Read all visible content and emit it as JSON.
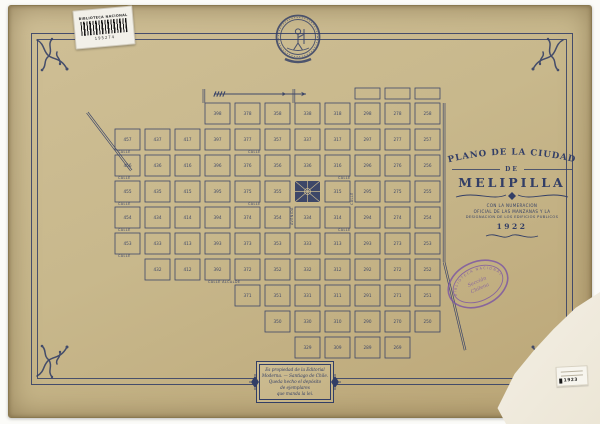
{
  "barcode": {
    "institution": "BIBLIOTECA NACIONAL",
    "number": "195274"
  },
  "cartouche": {
    "title": "PLANO DE LA CIUDAD",
    "de_label": "DE",
    "city": "MELIPILLA",
    "subtitle_lines": [
      "CON LA NUMERACION",
      "OFICIAL DE LAS MANZANAS Y LA",
      "DESIGNACION DE LOS EDIFICIOS PUBLICOS"
    ],
    "year": "1922"
  },
  "stamp": {
    "ring_text": "BIBLIOTECA NACIONAL",
    "center_line1": "Sección",
    "center_line2": "Chilena",
    "color": "#7a54a4"
  },
  "imprint": {
    "lines": [
      "Es propiedad de la Editorial",
      "Moderna. — Santiago de Chile.",
      "Queda hecho el depósito",
      "de ejemplares",
      "que manda la lei."
    ]
  },
  "sticker": {
    "number": "1923"
  },
  "colors": {
    "paper": "#c8b88c",
    "ink": "#323e66",
    "stamp_purple": "#7a54a4"
  },
  "map": {
    "ink": "#323e66",
    "paper": "#cbbb90",
    "grid": {
      "x0": 115,
      "y0": 103,
      "cell_w": 30,
      "cell_h": 26,
      "block_w": 25,
      "block_h": 21
    },
    "rows": [
      [
        null,
        null,
        null,
        "398",
        "378",
        "358",
        "338",
        "318",
        "298",
        "278",
        "258"
      ],
      [
        "457",
        "437",
        "417",
        "397",
        "377",
        "357",
        "337",
        "317",
        "297",
        "277",
        "257"
      ],
      [
        "456",
        "436",
        "416",
        "396",
        "376",
        "356",
        "336",
        "316",
        "296",
        "276",
        "256"
      ],
      [
        "455",
        "435",
        "415",
        "395",
        "375",
        "355",
        null,
        "315",
        "295",
        "275",
        "255"
      ],
      [
        "454",
        "434",
        "414",
        "394",
        "374",
        "354",
        "334",
        "314",
        "294",
        "274",
        "254"
      ],
      [
        "453",
        "433",
        "413",
        "393",
        "373",
        "353",
        "333",
        "313",
        "293",
        "273",
        "253"
      ],
      [
        null,
        "432",
        "412",
        "392",
        "372",
        "352",
        "332",
        "312",
        "292",
        "272",
        "252"
      ],
      [
        null,
        null,
        null,
        null,
        "371",
        "351",
        "331",
        "311",
        "291",
        "271",
        "251"
      ],
      [
        null,
        null,
        null,
        null,
        null,
        "350",
        "330",
        "310",
        "290",
        "270",
        "250"
      ],
      [
        null,
        null,
        null,
        null,
        null,
        null,
        "329",
        "309",
        "289",
        "269",
        null
      ]
    ],
    "plaza": {
      "row": 3,
      "col": 6
    },
    "extra_blocks": [
      {
        "x": 355,
        "y": 88,
        "w": 25,
        "h": 11
      },
      {
        "x": 385,
        "y": 88,
        "w": 25,
        "h": 11
      },
      {
        "x": 415,
        "y": 88,
        "w": 25,
        "h": 11
      }
    ],
    "roads": [
      {
        "x1": 88,
        "y1": 112,
        "x2": 132,
        "y2": 170
      },
      {
        "x1": 445,
        "y1": 103,
        "x2": 445,
        "y2": 262
      },
      {
        "x1": 445,
        "y1": 262,
        "x2": 466,
        "y2": 350
      },
      {
        "x1": 293,
        "y1": 103,
        "x2": 293,
        "y2": 89
      },
      {
        "x1": 203,
        "y1": 103,
        "x2": 203,
        "y2": 89
      }
    ],
    "street_labels": [
      {
        "x": 118,
        "y": 153,
        "t": "CALLE",
        "r": 0
      },
      {
        "x": 248,
        "y": 153,
        "t": "CALLE",
        "r": 0
      },
      {
        "x": 118,
        "y": 179,
        "t": "CALLE",
        "r": 0
      },
      {
        "x": 338,
        "y": 179,
        "t": "CALLE",
        "r": 0
      },
      {
        "x": 118,
        "y": 205,
        "t": "CALLE",
        "r": 0
      },
      {
        "x": 248,
        "y": 205,
        "t": "CALLE",
        "r": 0
      },
      {
        "x": 118,
        "y": 231,
        "t": "CALLE",
        "r": 0
      },
      {
        "x": 338,
        "y": 231,
        "t": "CALLE",
        "r": 0
      },
      {
        "x": 118,
        "y": 257,
        "t": "CALLE",
        "r": 0
      },
      {
        "x": 208,
        "y": 283,
        "t": "CALLE ALCALDE",
        "r": 0
      },
      {
        "x": 293,
        "y": 225,
        "t": "AVENIDA",
        "r": -90
      },
      {
        "x": 353,
        "y": 205,
        "t": "CALLE",
        "r": -90
      }
    ],
    "north_arrow": {
      "x1": 214,
      "x2": 306,
      "y": 94
    }
  }
}
